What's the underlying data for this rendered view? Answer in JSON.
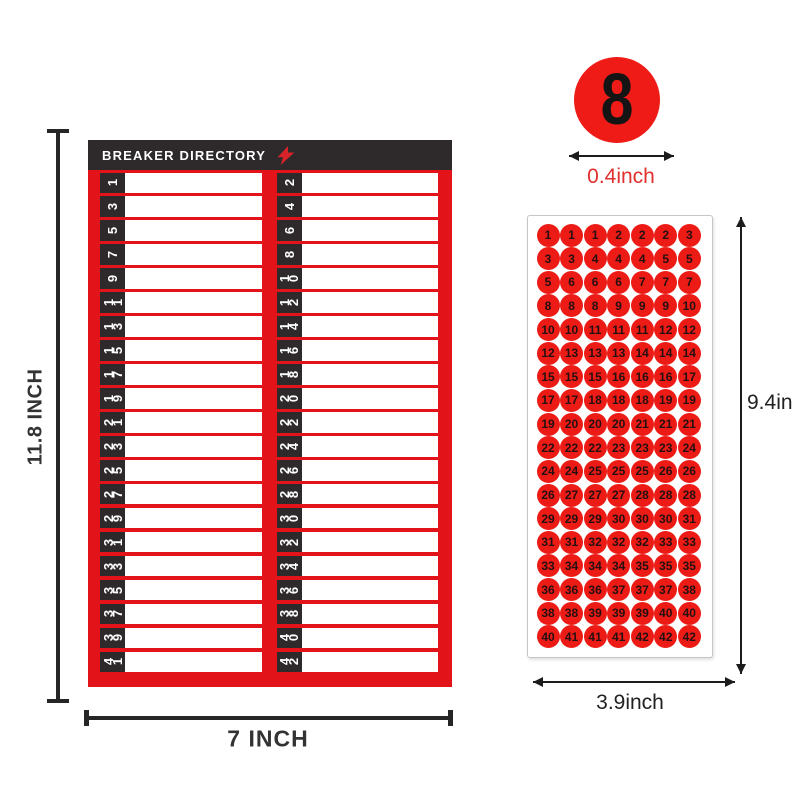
{
  "colors": {
    "panel_red": "#e31419",
    "header_dark": "#2e2a2b",
    "sticker_red": "#ec1b16",
    "sticker_number_color": "#241010",
    "dimension_text_dark": "#333333",
    "diameter_text_red": "#e0302e",
    "bolt_red": "#d8232b"
  },
  "breaker_panel": {
    "title": "BREAKER DIRECTORY",
    "bolt_icon": "lightning-bolt-icon",
    "left_numbers": [
      1,
      3,
      5,
      7,
      9,
      11,
      13,
      15,
      17,
      19,
      21,
      23,
      25,
      27,
      29,
      31,
      33,
      35,
      37,
      39,
      41
    ],
    "right_numbers": [
      2,
      4,
      6,
      8,
      10,
      12,
      14,
      16,
      18,
      20,
      22,
      24,
      26,
      28,
      30,
      32,
      34,
      36,
      38,
      40,
      42
    ]
  },
  "annotations": {
    "panel_height": "11.8 INCH",
    "panel_width": "7 INCH",
    "sample_sticker_number": "8",
    "sticker_diameter": "0.4inch",
    "sheet_height": "9.4in",
    "sheet_width": "3.9inch"
  },
  "sticker_sheet": {
    "columns": 7,
    "rows": 18,
    "numbers": [
      1,
      1,
      1,
      2,
      2,
      2,
      3,
      3,
      3,
      4,
      4,
      4,
      5,
      5,
      5,
      6,
      6,
      6,
      7,
      7,
      7,
      8,
      8,
      8,
      9,
      9,
      9,
      10,
      10,
      10,
      11,
      11,
      11,
      12,
      12,
      12,
      13,
      13,
      13,
      14,
      14,
      14,
      15,
      15,
      15,
      16,
      16,
      16,
      17,
      17,
      17,
      18,
      18,
      18,
      19,
      19,
      19,
      20,
      20,
      20,
      21,
      21,
      21,
      22,
      22,
      22,
      23,
      23,
      23,
      24,
      24,
      24,
      25,
      25,
      25,
      26,
      26,
      26,
      27,
      27,
      27,
      28,
      28,
      28,
      29,
      29,
      29,
      30,
      30,
      30,
      31,
      31,
      31,
      32,
      32,
      32,
      33,
      33,
      33,
      34,
      34,
      34,
      35,
      35,
      35,
      36,
      36,
      36,
      37,
      37,
      37,
      38,
      38,
      38,
      39,
      39,
      39,
      40,
      40,
      40,
      41,
      41,
      41,
      42,
      42,
      42
    ]
  }
}
